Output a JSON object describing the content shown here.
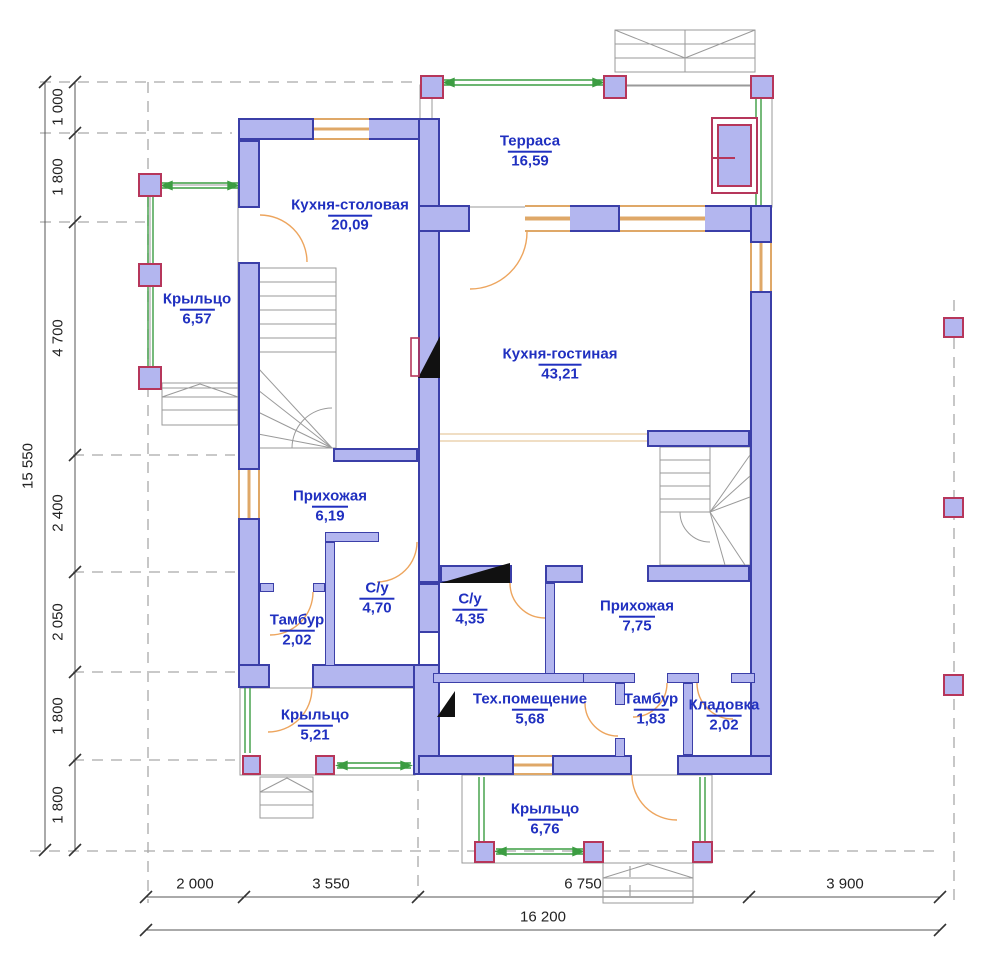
{
  "plan_title": "Floor plan — first floor",
  "rooms": {
    "terrace": {
      "name": "Терраса",
      "area": "16,59"
    },
    "kitchen_dining": {
      "name": "Кухня-столовая",
      "area": "20,09"
    },
    "porch_left": {
      "name": "Крыльцо",
      "area": "6,57"
    },
    "kitchen_living": {
      "name": "Кухня-гостиная",
      "area": "43,21"
    },
    "hallway_1": {
      "name": "Прихожая",
      "area": "6,19"
    },
    "bathroom_1": {
      "name": "С/у",
      "area": "4,70"
    },
    "vestibule_1": {
      "name": "Тамбур",
      "area": "2,02"
    },
    "bathroom_2": {
      "name": "С/у",
      "area": "4,35"
    },
    "hallway_2": {
      "name": "Прихожая",
      "area": "7,75"
    },
    "porch_bottom_left": {
      "name": "Крыльцо",
      "area": "5,21"
    },
    "tech_room": {
      "name": "Тех.помещение",
      "area": "5,68"
    },
    "vestibule_2": {
      "name": "Тамбур",
      "area": "1,83"
    },
    "storage": {
      "name": "Кладовка",
      "area": "2,02"
    },
    "porch_bottom": {
      "name": "Крыльцо",
      "area": "6,76"
    }
  },
  "dims": {
    "left": [
      "1 000",
      "1 800",
      "4 700",
      "2 400",
      "2 050",
      "1 800",
      "1 800"
    ],
    "left_total": "15 550",
    "bottom": [
      "2 000",
      "3 550",
      "6 750",
      "3 900"
    ],
    "bottom_total": "16 200"
  },
  "colors": {
    "wall_fill": "#b3b6ef",
    "wall_outline": "#3b3fa8",
    "column_outline": "#b6365b",
    "window": "#dfa868",
    "door_arc": "#eda55e",
    "railing": "#3c9d42",
    "room_text": "#2030c0",
    "dimension_text": "#222222"
  }
}
